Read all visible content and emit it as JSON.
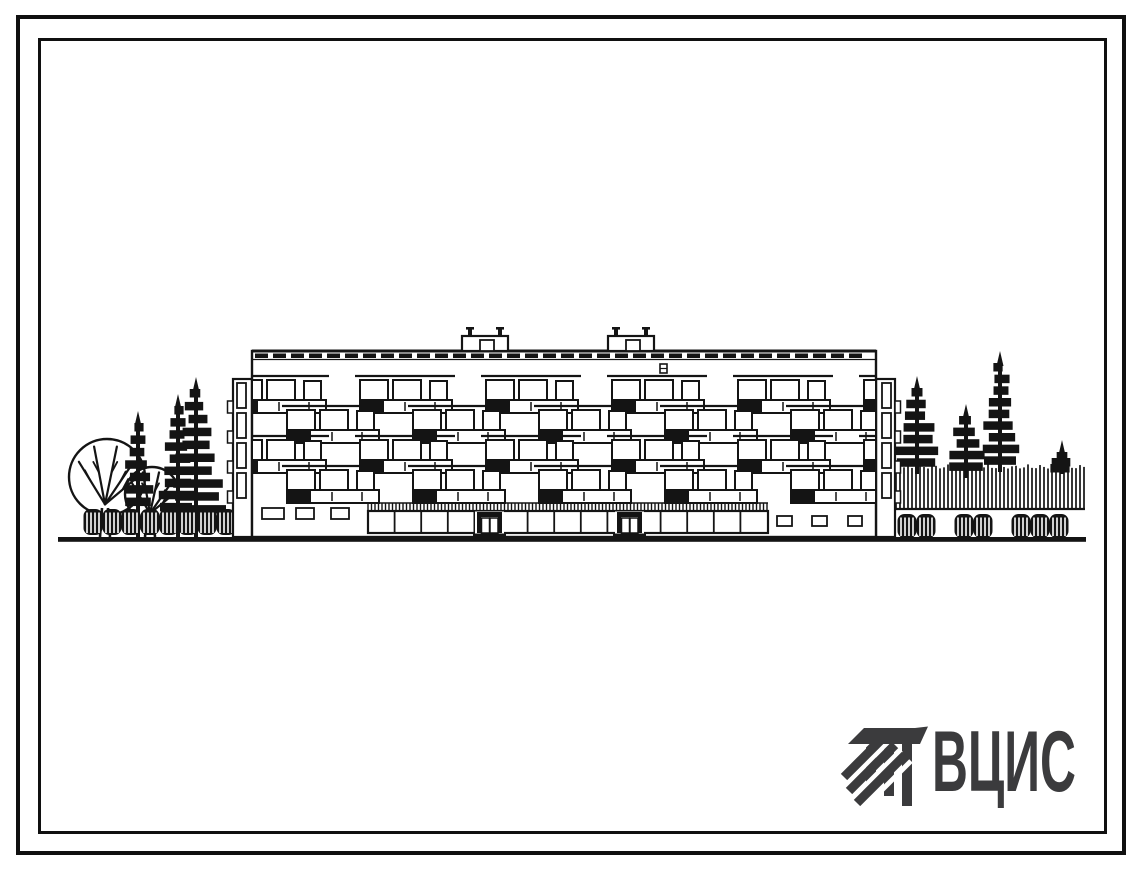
{
  "logo": {
    "text": "ВЦИС",
    "color": "#3b3b3d",
    "mark": "hatched-beam-mark"
  },
  "drawing": {
    "ink": "#141414",
    "paper": "#ffffff",
    "ground": {
      "x1": 58,
      "x2": 1086,
      "y": 537,
      "thickness": 4.8
    },
    "building": {
      "facade": {
        "x": 252,
        "y": 351,
        "w": 624,
        "h": 186
      },
      "parapet": {
        "y": 353.5,
        "dash_w": 13,
        "dash_h": 4.5,
        "step": 18
      },
      "roof_boxes": [
        462,
        608
      ],
      "vent": {
        "x": 660,
        "y": 364,
        "w": 7,
        "h": 9
      },
      "floors": {
        "count": 4,
        "window_top_first": 380,
        "spacing": 30,
        "module_w": 126,
        "starts_even": [
          209,
          335,
          461,
          587,
          713,
          839
        ],
        "starts_odd": [
          262,
          388,
          514,
          640,
          766
        ]
      },
      "frieze": {
        "x1": 368,
        "x2": 768,
        "y1": 503,
        "y2": 511,
        "step": 3.5
      },
      "storefront": {
        "x1": 368,
        "x2": 768,
        "y1": 511,
        "y2": 533,
        "mullion_step": 26.6
      },
      "doors": [
        477,
        617
      ],
      "ground_windows_left": [
        [
          262,
          508,
          22,
          11
        ],
        [
          296,
          508,
          18,
          11
        ],
        [
          331,
          508,
          18,
          11
        ]
      ],
      "ground_windows_right": [
        [
          777,
          516,
          15,
          10
        ],
        [
          812,
          516,
          15,
          10
        ],
        [
          848,
          516,
          14,
          10
        ]
      ],
      "wings": {
        "left_x": 233,
        "right_x": 876,
        "y": 379,
        "w": 19,
        "h": 158
      }
    },
    "trees": {
      "deciduous": [
        [
          107,
          477,
          38
        ],
        [
          152,
          494,
          27
        ]
      ],
      "conifers_left": [
        [
          138,
          417,
          510,
          12
        ],
        [
          178,
          400,
          515,
          16
        ],
        [
          196,
          383,
          518,
          26
        ]
      ],
      "conifers_right": [
        [
          917,
          382,
          470,
          20
        ],
        [
          966,
          410,
          474,
          17
        ],
        [
          1000,
          357,
          468,
          16
        ],
        [
          1062,
          446,
          470,
          8
        ]
      ],
      "hedge": {
        "x1": 892,
        "x2": 1085,
        "y1": 462,
        "y2": 509
      },
      "bushes_left": {
        "x1": 84,
        "x2": 232,
        "y": 509,
        "h": 26,
        "gaps": []
      },
      "bushes_right": {
        "x1": 898,
        "x2": 1078,
        "y": 514,
        "h": 24,
        "gaps": [
          950,
          1008
        ]
      }
    }
  }
}
